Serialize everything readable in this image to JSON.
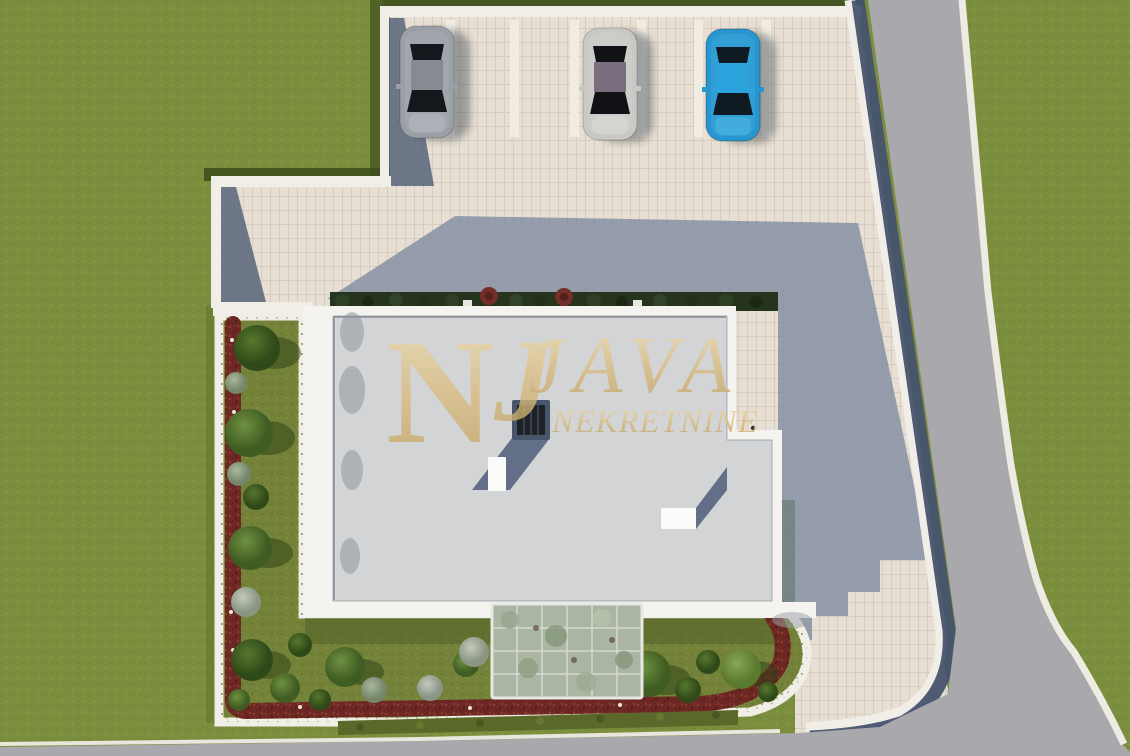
{
  "scene": {
    "kind": "aerial-3d-site-render",
    "label": "Top-down 3D visualization of a flat-roof house plot with parking, garden beds and access road"
  },
  "watermark": {
    "monogram_primary": "N",
    "monogram_secondary": "J",
    "title": "JAVA",
    "subtitle": "NEKRETNINE",
    "color": "#d9c185"
  },
  "palette": {
    "grass": "#7b8e3d",
    "grass_dark": "#3f501d",
    "garden_grass": "#75823a",
    "pavement": "#e7dfd3",
    "pavement_stripe": "#f2ede3",
    "pavement_shadow": "#76839c",
    "road": "#a9a8ac",
    "curb": "#f1eee7",
    "navy": "#46536e",
    "roof": "#d3d4d6",
    "parapet": "#f4f3f0",
    "mulch": "#6e2823",
    "hedge": "#26331d",
    "pergola": "#aab5a3",
    "skylight_frame": "#47566a",
    "skylight_glass": "#1e2227",
    "chimney": "#fbfbfa"
  },
  "vehicles": [
    {
      "name": "car-silver-gray",
      "body": "#9aa0a6",
      "roof": "#878b91",
      "glass": "#14171c",
      "hood": "#aeb3b8"
    },
    {
      "name": "car-silver-white",
      "body": "#c9c8c5",
      "roof": "#7a6f7e",
      "glass": "#101215",
      "hood": "#d6d5d2"
    },
    {
      "name": "car-blue",
      "body": "#2795d0",
      "roof": "#2ba3dc",
      "glass": "#101a23",
      "hood": "#45aede"
    }
  ]
}
